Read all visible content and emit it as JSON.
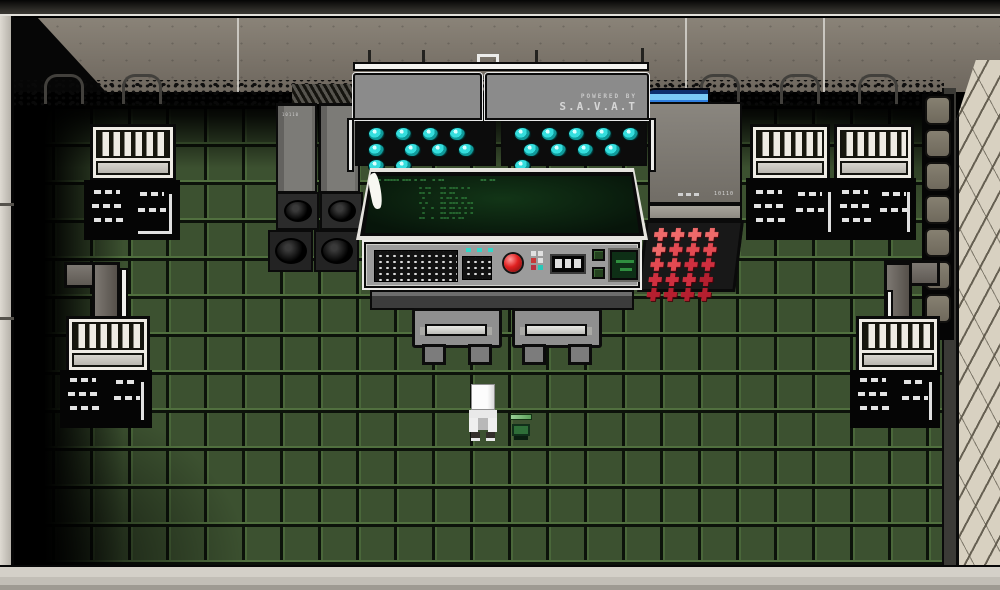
{
  "scene": {
    "name": "retro top-down sci-fi control room",
    "player": "white-suit character",
    "companion": "small green unit"
  },
  "console": {
    "powered_by": "POWERED BY",
    "brand": "S.A.V.A.T",
    "brand_sub": "▪▪▪▪▪▪▪▪▪▪▪▪▪▪▪▪▪▪▪▪▪▪▪▪▪▪",
    "lights_per_panel": 10,
    "screen": {
      "lines": [
        "== ===== === = ==  = ==            == ==",
        "  = ==   == === = =",
        "  == =   == ==",
        "   =     = == = ==",
        "  = =    == === = ==",
        "   =  =  == == = = =",
        "   =     == ==== = =",
        "  ==  =  === = =="
      ]
    }
  },
  "left_unit": {
    "label": "10110"
  },
  "right_unit": {
    "label": "10110",
    "buttons": {
      "rows": 4,
      "cols": 5,
      "row_colors": [
        "#ef6a6a",
        "#e34a52",
        "#cf2f3f",
        "#b51f2f"
      ]
    }
  },
  "decor": {
    "stone_tiles": 7
  },
  "colors": {
    "accent_teal": "#35dede",
    "alert_red": "#e02020",
    "screen_green": "#3ca24c",
    "pipe_blue": "#2f7fe0",
    "floor_green": "#3c5130"
  }
}
